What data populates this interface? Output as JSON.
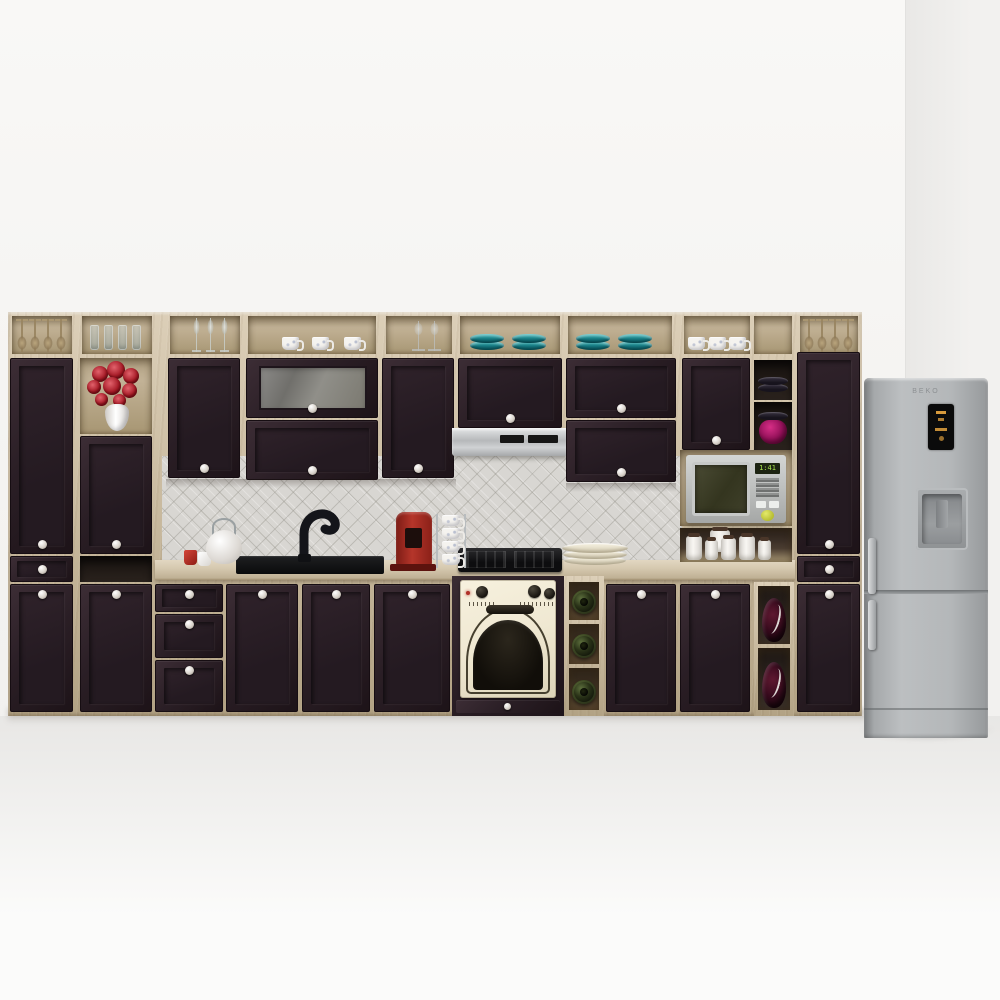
{
  "scene": {
    "type": "3d product render",
    "title": "Kitchen cabinet set: dark espresso doors with light oak carcass, open shelving and appliances",
    "fridge": {
      "brand": "BEKO"
    },
    "microwave": {
      "display": "1:41"
    },
    "inventory": {
      "shelf_items": [
        {
          "name": "inverted oak-tone stem glasses",
          "location": "left tall unit top shelf",
          "count": 4
        },
        {
          "name": "tumbler glasses",
          "location": "second left top shelf",
          "count": 4
        },
        {
          "name": "tall stem glasses",
          "location": "left wall shelf",
          "count": 3
        },
        {
          "name": "white cups with blue floral pattern",
          "location": "center wall shelf",
          "count": 3
        },
        {
          "name": "clear wine glasses",
          "location": "wall shelf right of cups",
          "count": 2
        },
        {
          "name": "teal plate stacks",
          "location": "shelves above hood and right",
          "count": 4
        },
        {
          "name": "white patterned cups",
          "location": "right wall shelf",
          "count": 3
        },
        {
          "name": "inverted oak-tone wine glasses",
          "location": "right tall unit top shelf",
          "count": 4
        },
        {
          "name": "dark plate stack",
          "location": "upper right cubby",
          "count": 1
        },
        {
          "name": "magenta bowl with dark plate",
          "location": "upper right cubby",
          "count": 1
        }
      ],
      "counter_items": [
        {
          "name": "red espresso cup"
        },
        {
          "name": "white cup"
        },
        {
          "name": "white teapot"
        },
        {
          "name": "black undermount sink with black curved mixer tap"
        },
        {
          "name": "red capsule coffee machine"
        },
        {
          "name": "espresso cup tower",
          "count": 4
        },
        {
          "name": "cream dinner plate stack"
        },
        {
          "name": "white canister set",
          "count": 6
        }
      ],
      "appliances": [
        {
          "name": "stainless slide-out cooker hood"
        },
        {
          "name": "black gas hob"
        },
        {
          "name": "cream retro built-in oven with arched glass door"
        },
        {
          "name": "stainless microwave with green display"
        },
        {
          "name": "silver fridge-freezer with water dispenser and amber display"
        }
      ],
      "decor": [
        {
          "name": "red flower bouquet in white vase"
        },
        {
          "name": "wine bottles in cubbies",
          "count": 3
        },
        {
          "name": "dark purple decorative vases with white pattern",
          "count": 2
        }
      ]
    }
  },
  "colors": {
    "wall": "#f7f6f4",
    "wall-corner": "#e9e8e6",
    "floor": "#e8e7e5",
    "wood": "#c8b99e",
    "wood-hi": "#dccfb8",
    "wood-lo": "#b2a284",
    "wood-niche": "#c2b296",
    "wood-niche2": "#a79673",
    "door": "#2b1f26",
    "door-dark": "#1d1318",
    "door-light": "#3c2d35",
    "counter": "#d6c9b0",
    "backsplash": "#d8d6d2",
    "oven-cream": "#efe8d2",
    "teal": "#15767e",
    "magenta": "#8f0f56",
    "fridge-silver": "#bcbfc1",
    "display-amber": "#d79a3c",
    "display-green": "#a6e34e",
    "accent-red": "#b03028"
  }
}
